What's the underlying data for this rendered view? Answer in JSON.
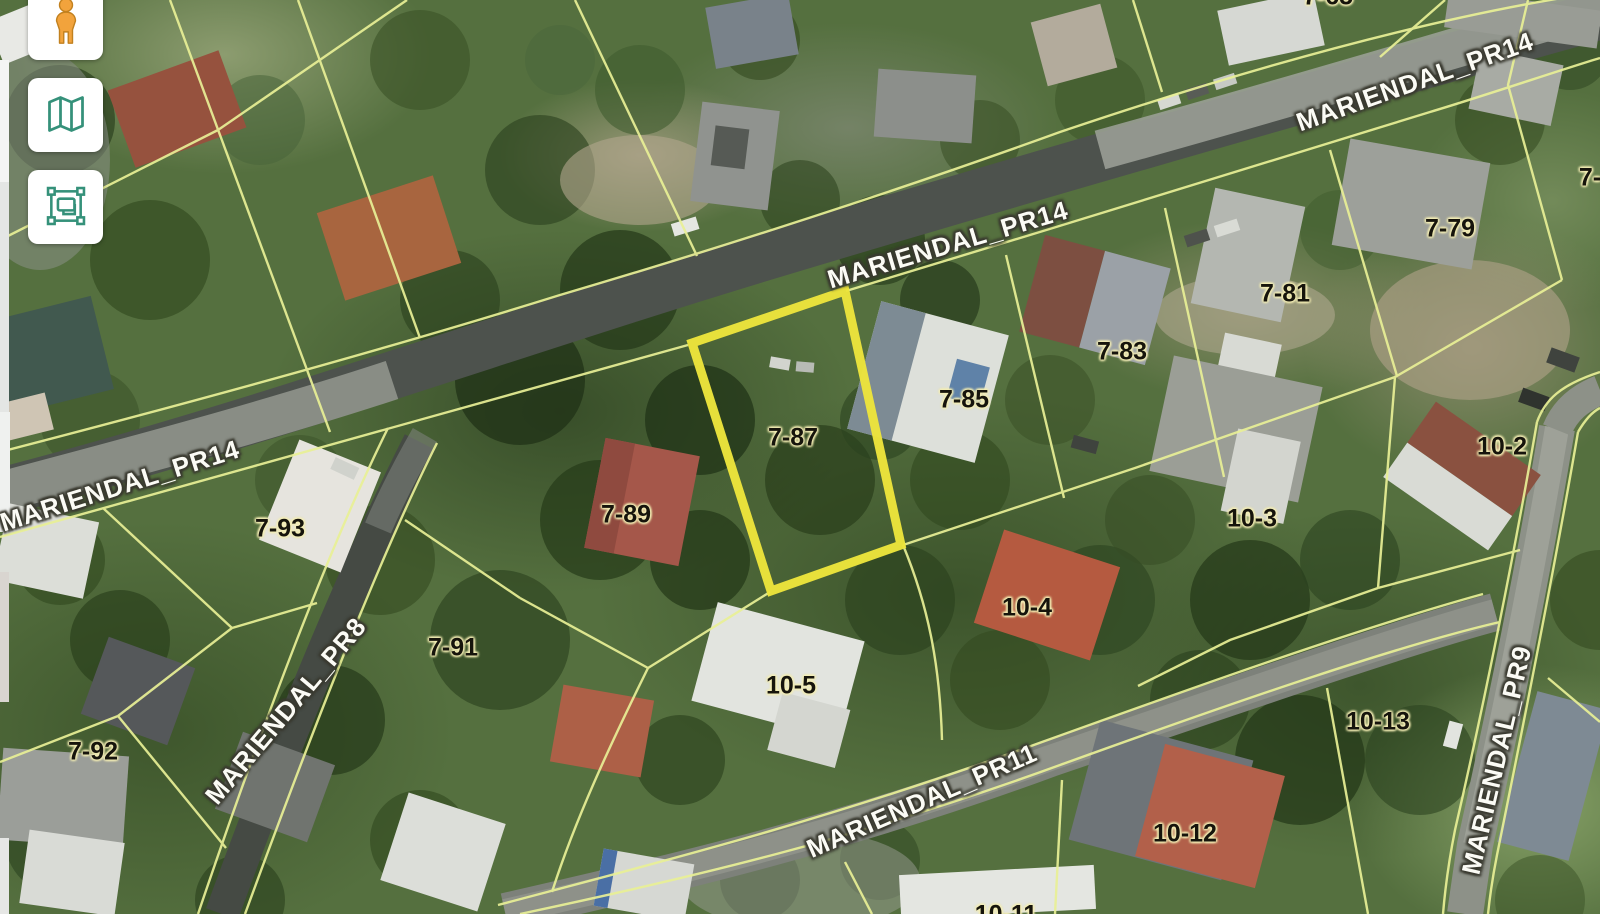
{
  "toolbar": {
    "buttons": [
      {
        "id": "pegman",
        "icon": "pegman-icon"
      },
      {
        "id": "basemap",
        "icon": "map-icon"
      },
      {
        "id": "select-extent",
        "icon": "select-extent-icon"
      }
    ]
  },
  "map": {
    "highlighted_parcel": {
      "label": "7-87",
      "outline_color": "#ece43c"
    },
    "parcel_labels": [
      {
        "text": "7-93",
        "x": 280,
        "y": 529,
        "rot": 0
      },
      {
        "text": "7-91",
        "x": 453,
        "y": 648,
        "rot": 0
      },
      {
        "text": "7-92",
        "x": 93,
        "y": 752,
        "rot": 0
      },
      {
        "text": "7-89",
        "x": 626,
        "y": 515,
        "rot": 0
      },
      {
        "text": "7-87",
        "x": 793,
        "y": 438,
        "rot": 0
      },
      {
        "text": "7-85",
        "x": 964,
        "y": 400,
        "rot": 0
      },
      {
        "text": "7-83",
        "x": 1122,
        "y": 352,
        "rot": 0
      },
      {
        "text": "7-81",
        "x": 1285,
        "y": 294,
        "rot": 0
      },
      {
        "text": "7-79",
        "x": 1450,
        "y": 229,
        "rot": 0
      },
      {
        "text": "7-65",
        "x": 1328,
        "y": -3,
        "rot": 0
      },
      {
        "text": "7-",
        "x": 1590,
        "y": 178,
        "rot": 0
      },
      {
        "text": "10-2",
        "x": 1502,
        "y": 447,
        "rot": 0
      },
      {
        "text": "10-3",
        "x": 1252,
        "y": 519,
        "rot": 0
      },
      {
        "text": "10-4",
        "x": 1027,
        "y": 608,
        "rot": 0
      },
      {
        "text": "10-5",
        "x": 791,
        "y": 686,
        "rot": 0
      },
      {
        "text": "10-13",
        "x": 1378,
        "y": 722,
        "rot": 0
      },
      {
        "text": "10-12",
        "x": 1185,
        "y": 834,
        "rot": 0
      },
      {
        "text": "10-11",
        "x": 1006,
        "y": 915,
        "rot": 0
      }
    ],
    "road_labels": [
      {
        "text": "MARIENDAL_PR14",
        "x": 120,
        "y": 486,
        "rot": -17.5
      },
      {
        "text": "MARIENDAL_PR14",
        "x": 948,
        "y": 245,
        "rot": -16.5
      },
      {
        "text": "MARIENDAL_PR14",
        "x": 1415,
        "y": 82,
        "rot": -19.5
      },
      {
        "text": "MARIENDAL_PR8",
        "x": 286,
        "y": 711,
        "rot": -50
      },
      {
        "text": "MARIENDAL_PR11",
        "x": 922,
        "y": 801,
        "rot": -23.5
      },
      {
        "text": "MARIENDAL_PR9",
        "x": 1497,
        "y": 760,
        "rot": -77
      }
    ]
  },
  "colors": {
    "highlight_outline": "#ece43c",
    "parcel_line": "#e9f096",
    "parcel_label_text": "#16140c",
    "parcel_label_glow": "#f2ecb4",
    "road_label_text": "#fbfbf5",
    "road_label_outline": "#3a3a30",
    "button_bg": "#ffffff",
    "pegman_orange": "#f2a33c",
    "tool_icon_green": "#35917a"
  }
}
